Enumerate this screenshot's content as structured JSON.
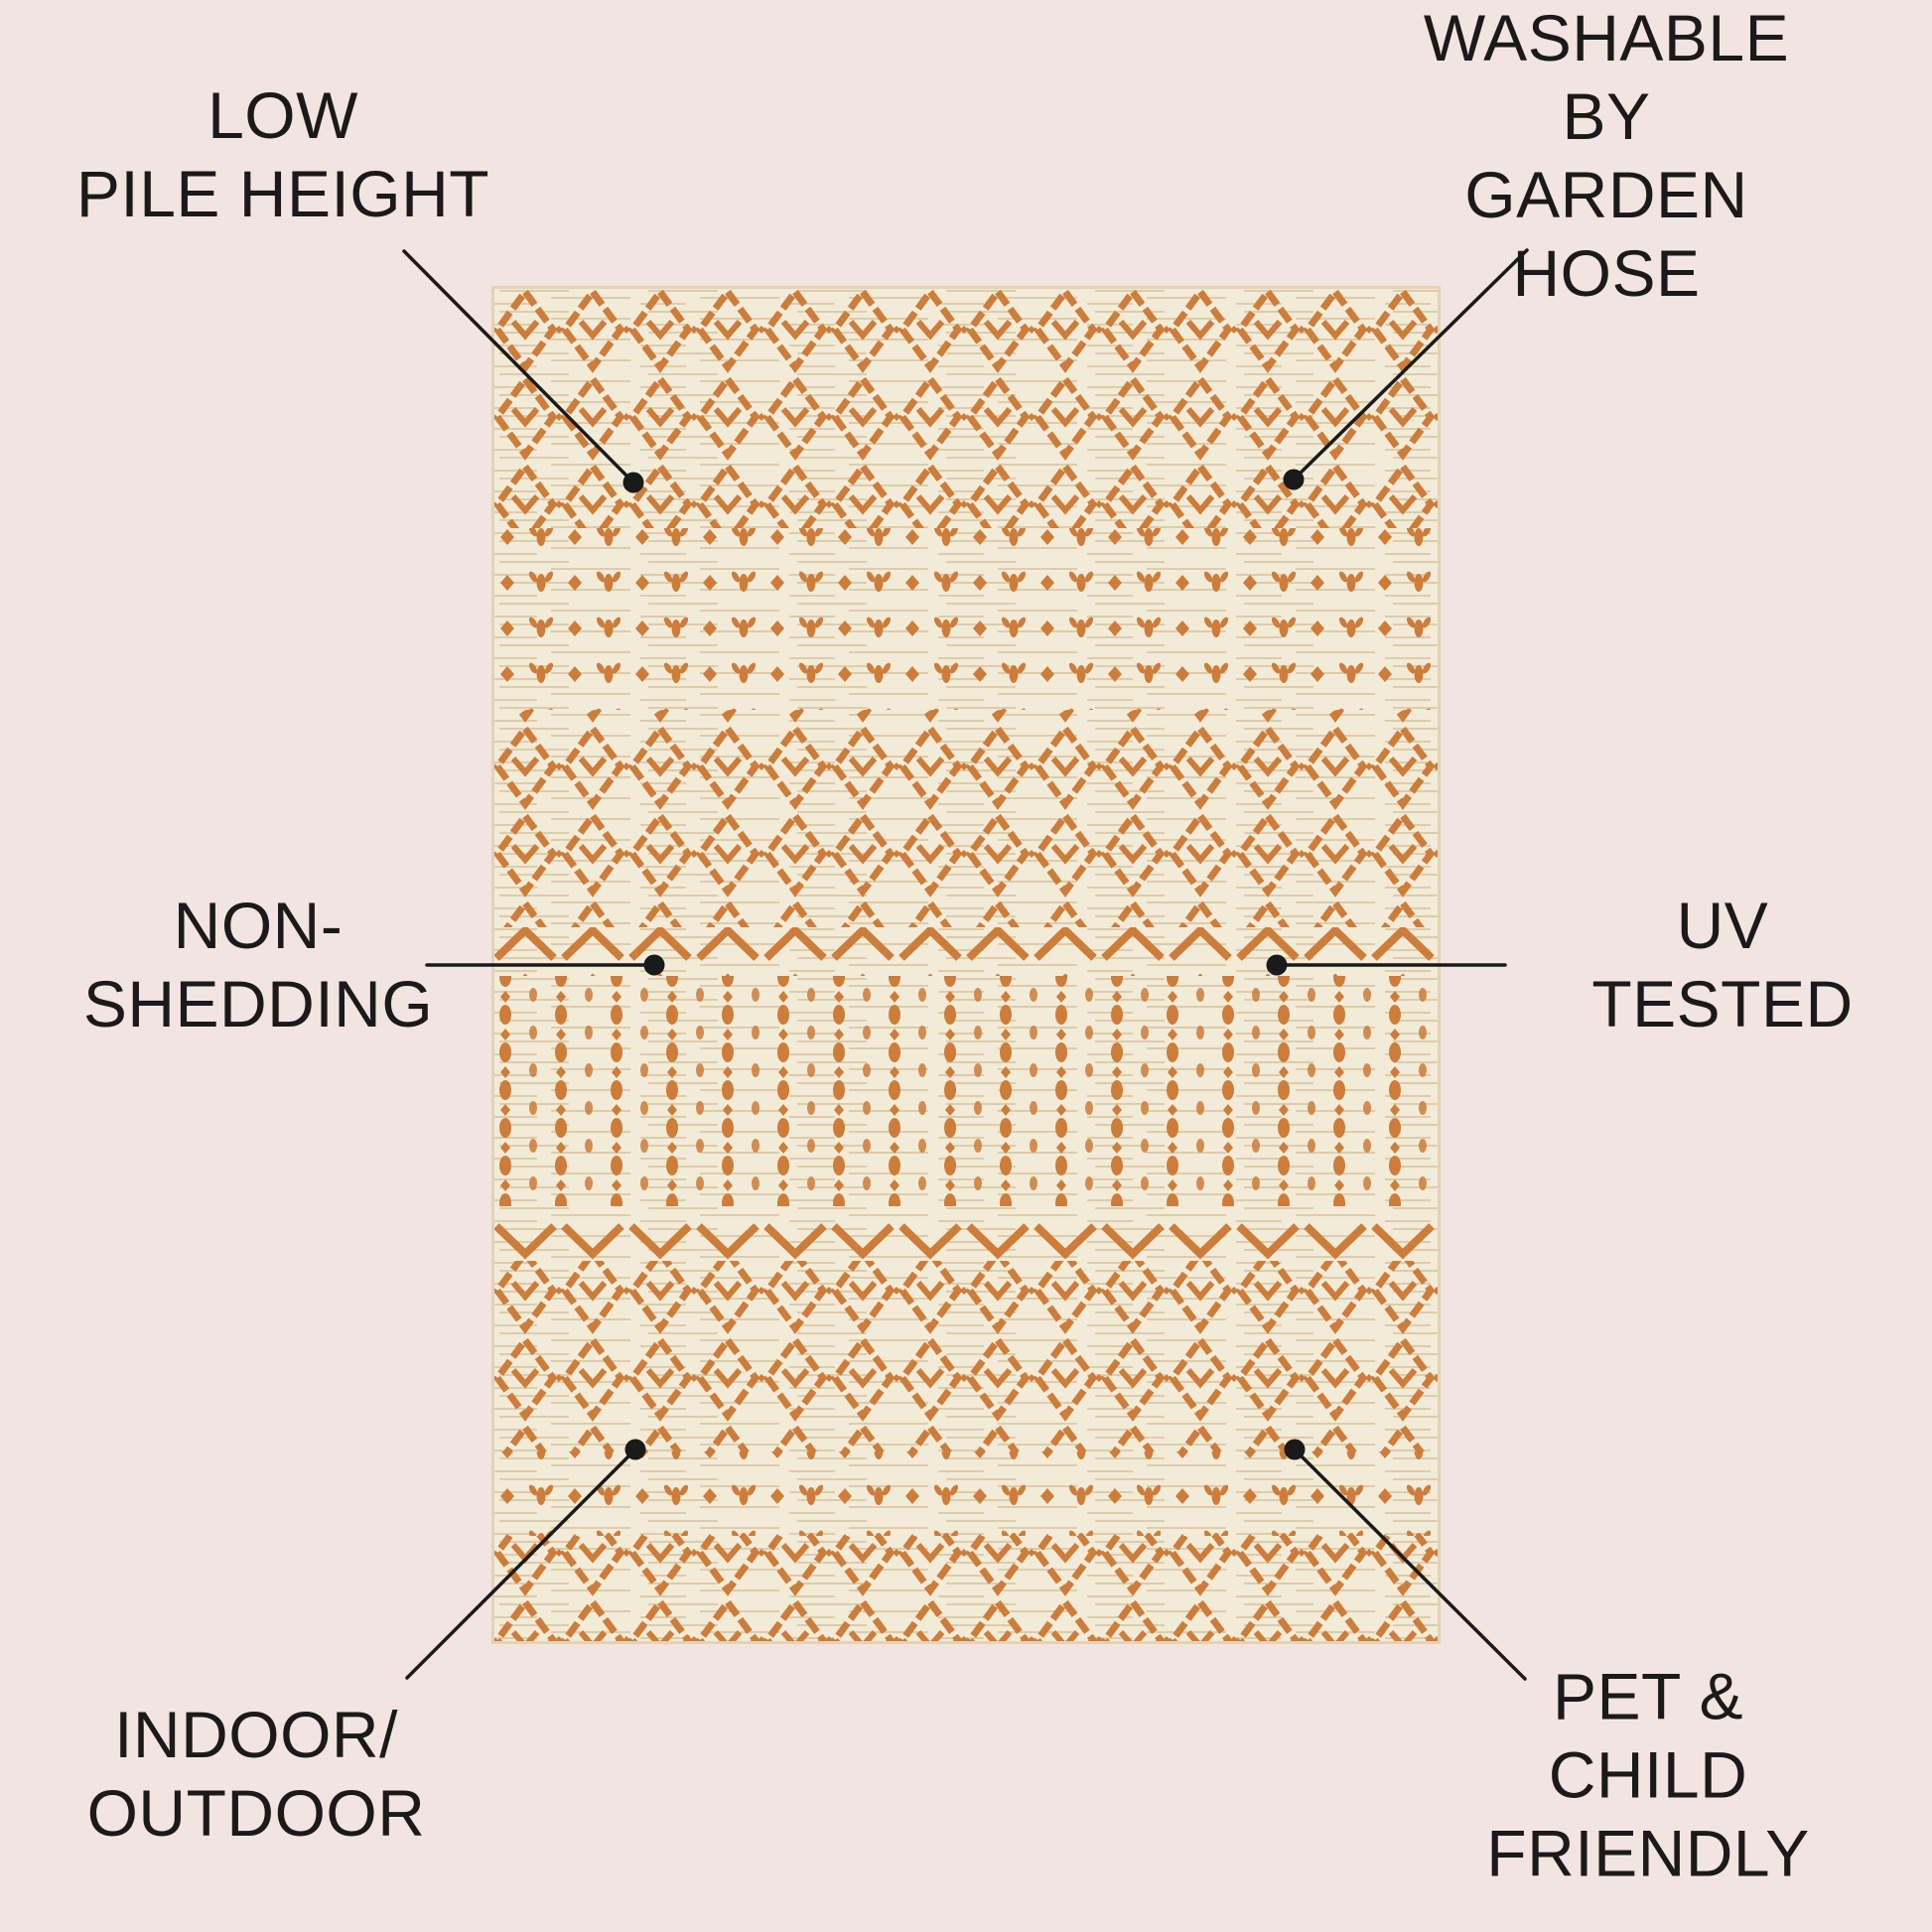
{
  "page": {
    "background_color": "#f2e4e0",
    "ink_color": "#1a1a1a"
  },
  "rug": {
    "description": "moroccan-trellis-area-rug",
    "base_color": "#f2ebd8",
    "pattern_color": "#cd7c3a",
    "weave_streak_color": "#dbc9a5"
  },
  "callouts": [
    {
      "id": "low-pile-height",
      "position": "top-left",
      "label": "LOW\nPILE HEIGHT"
    },
    {
      "id": "washable-by-garden-hose",
      "position": "top-right",
      "label": "WASHABLE BY\nGARDEN HOSE"
    },
    {
      "id": "non-shedding",
      "position": "middle-left",
      "label": "NON-\nSHEDDING"
    },
    {
      "id": "uv-tested",
      "position": "middle-right",
      "label": "UV\nTESTED"
    },
    {
      "id": "indoor-outdoor",
      "position": "bottom-left",
      "label": "INDOOR/\nOUTDOOR"
    },
    {
      "id": "pet-child-friendly",
      "position": "bottom-right",
      "label": "PET & CHILD\nFRIENDLY"
    }
  ]
}
